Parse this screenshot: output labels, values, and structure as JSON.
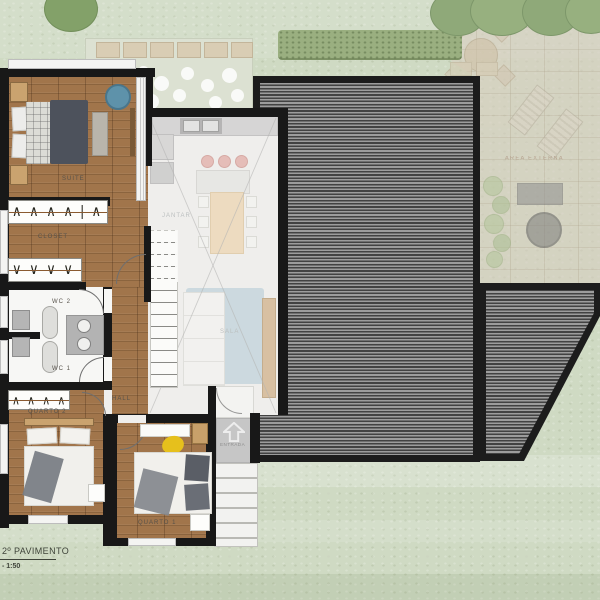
{
  "plan": {
    "title": "2º PAVIMENTO",
    "scale": "- 1:50"
  },
  "rooms": {
    "suite": "SUITE",
    "closet": "CLOSET",
    "wc2": "WC 2",
    "wc1": "WC 1",
    "quarto2": "QUARTO 2",
    "quarto1": "QUARTO 1",
    "hall": "HALL",
    "jantar": "JANTAR",
    "sala": "SALA",
    "area_externa": "AREA EXTERNA",
    "entrada": "ENTRADA"
  },
  "symbols": {
    "rack_top": "∧ ∧ ∧ ∧ | ∧ ∧ ∧",
    "rack_bottom": "∨ ∨ ∨ ∨ ∨",
    "rack_quarto2": "∧ ∧ ∧ ∧"
  },
  "colors": {
    "wall": "#181818",
    "roof_dark": "#424242",
    "roof_light": "#9c9c9c",
    "grass": "#cfdac3",
    "wood_floor": "#a1754b",
    "patio_stone": "#d8cfc1",
    "armchair_blue": "#5e92aa",
    "rug_blue": "#adc8d3",
    "stool_pink": "#e09d96",
    "beanbag_yellow": "#e6c01c"
  }
}
